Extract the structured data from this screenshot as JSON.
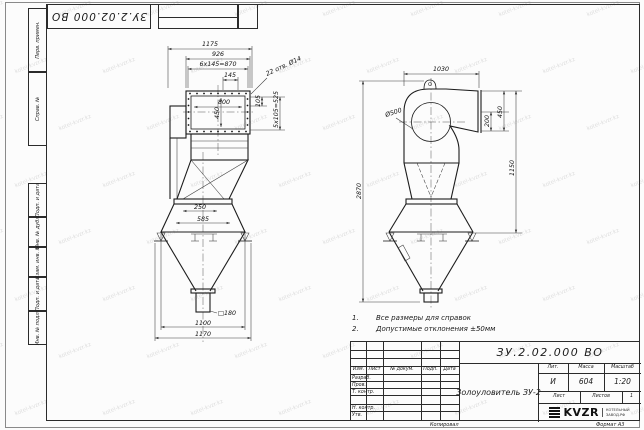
{
  "doc": {
    "number": "ЗУ.2.02.000 ВО",
    "title": "Золоуловитель ЗУ-2"
  },
  "watermark": {
    "text": "kotel-kvzr.kz"
  },
  "frame": {
    "margin_boxes": [
      {
        "label": "Перв. примен."
      },
      {
        "label": "Справ. №"
      },
      {
        "label": "Подп. и дата"
      },
      {
        "label": "Инв. № дубл."
      },
      {
        "label": "Взам. инв. №"
      },
      {
        "label": "Подп. и дата"
      },
      {
        "label": "Инв. № подл."
      }
    ],
    "copied_label": "Копировал",
    "format_label": "Формат A3"
  },
  "notes": {
    "items": [
      {
        "num": "1.",
        "text": "Все размеры для справок"
      },
      {
        "num": "2.",
        "text": "Допустимые отклонения ±50мм"
      }
    ]
  },
  "front_view": {
    "dims": {
      "w_total": "1175",
      "w_flange": "926",
      "w_pitch": "6x145=870",
      "pitch": "145",
      "holes": "22 отв. Ø14",
      "inner_w": "800",
      "inner_h": "450",
      "side_pitch": "105",
      "side_total": "5x105=525",
      "outlet_gap": "250",
      "outlet_w": "585",
      "outlet_square": "□180",
      "cone_w": "1100",
      "base_w": "1170"
    }
  },
  "side_view": {
    "dims": {
      "w_total": "1030",
      "circle_dia": "Ø500",
      "flange_offset": "200",
      "flange_h": "450",
      "h_right": "1150",
      "h_total": "2870"
    }
  },
  "title_block": {
    "cols": {
      "izm": "Изм.",
      "list": "Лист",
      "doc": "№ докум.",
      "sign": "Подп.",
      "date": "Дата"
    },
    "rows": {
      "developed": "Разраб.",
      "checked": "Пров.",
      "tcontrol": "Т. контр.",
      "ncontrol": "Н. контр.",
      "approved": "Утв."
    },
    "lit_header": "Лит.",
    "mass_header": "Масса",
    "scale_header": "Масштаб",
    "lit": "И",
    "mass": "604",
    "scale": "1:20",
    "sheet_label": "Лист",
    "sheets_label": "Листов",
    "sheets_value": "1",
    "logo": {
      "text": "KVZR",
      "sub1": "КОТЕЛЬНЫЙ",
      "sub2": "ЗАВОД.РФ"
    }
  }
}
